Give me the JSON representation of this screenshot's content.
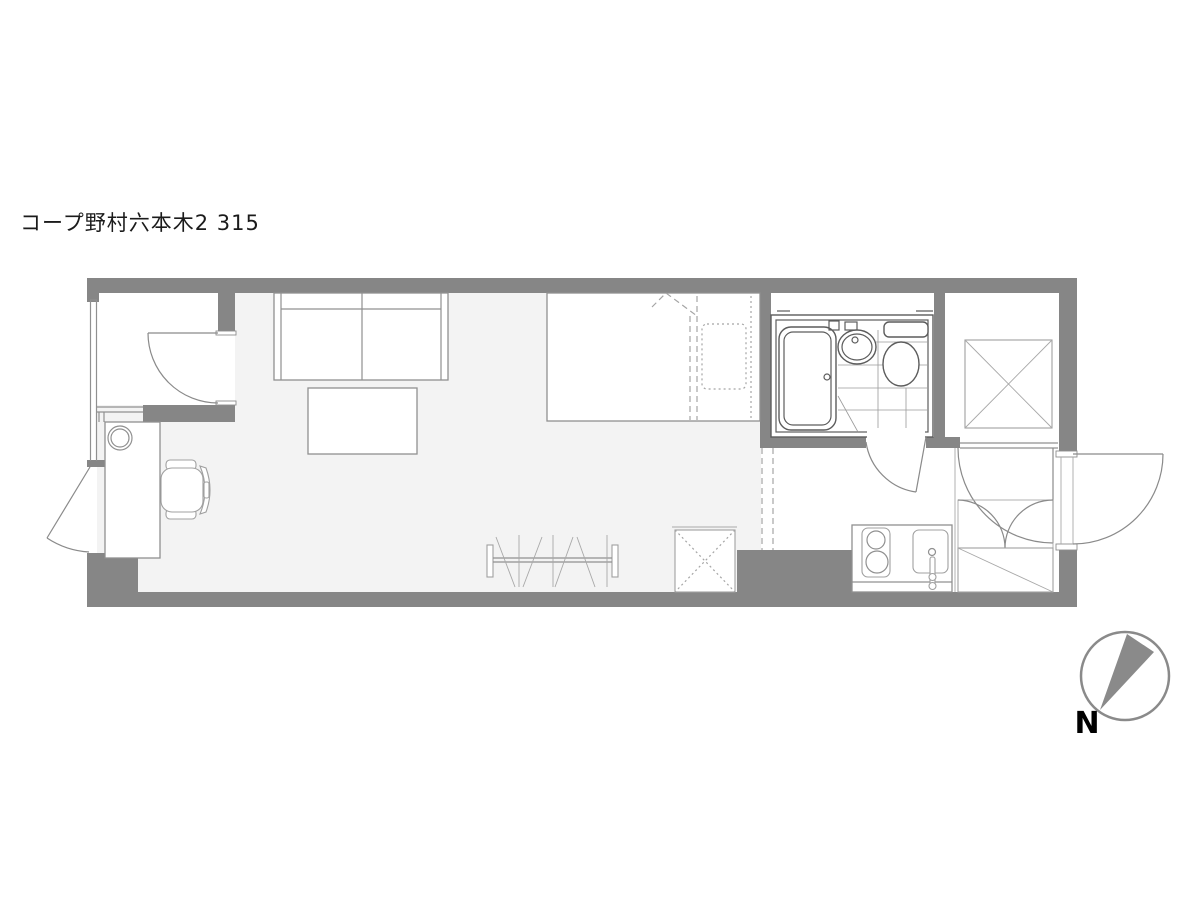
{
  "title": "コープ野村六本木2 315",
  "compass": {
    "label": "N"
  },
  "colors": {
    "wall_gray": "#868686",
    "floor_gray": "#f3f3f3",
    "line_gray": "#909090",
    "bath_line": "#5c5c5c",
    "needle_gray": "#8a8a8a"
  },
  "fixtures": [
    "walk-in-closet-door",
    "desk",
    "desk-lamp-circle",
    "office-chair",
    "sofa",
    "low-table",
    "bed",
    "pillow",
    "duvet-fold",
    "clothes-rack",
    "storage-box-dotted-x",
    "unit-bath",
    "bathtub",
    "washbasin",
    "toilet",
    "kitchen-counter",
    "gas-stove",
    "kitchen-sink",
    "closet-x-box",
    "double-door-cabinet",
    "shoe-cabinet",
    "entrance-door",
    "balcony-door",
    "bathroom-door",
    "closet-door",
    "north-compass"
  ]
}
